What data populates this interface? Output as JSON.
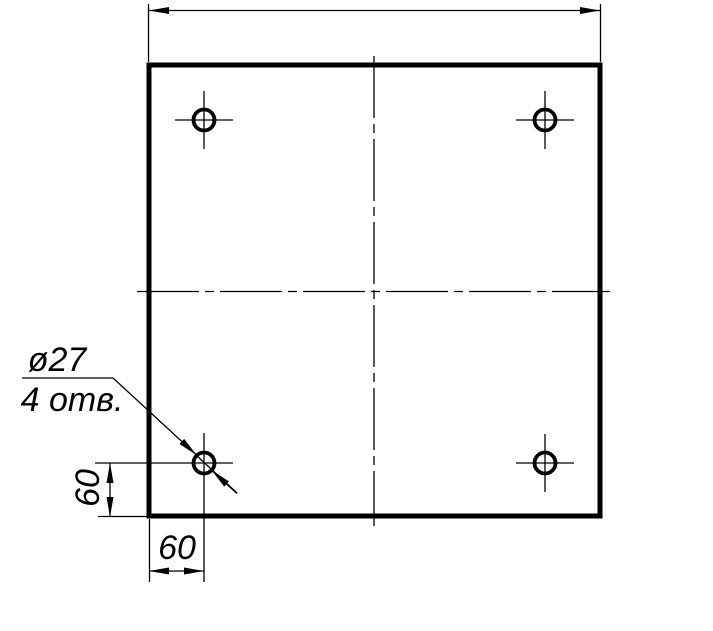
{
  "drawing": {
    "labels": {
      "hole_diameter": "ø27",
      "hole_count": "4 отв.",
      "dim_vertical": "60",
      "dim_horizontal": "60"
    },
    "colors": {
      "line": "#000000",
      "background": "#ffffff"
    }
  }
}
